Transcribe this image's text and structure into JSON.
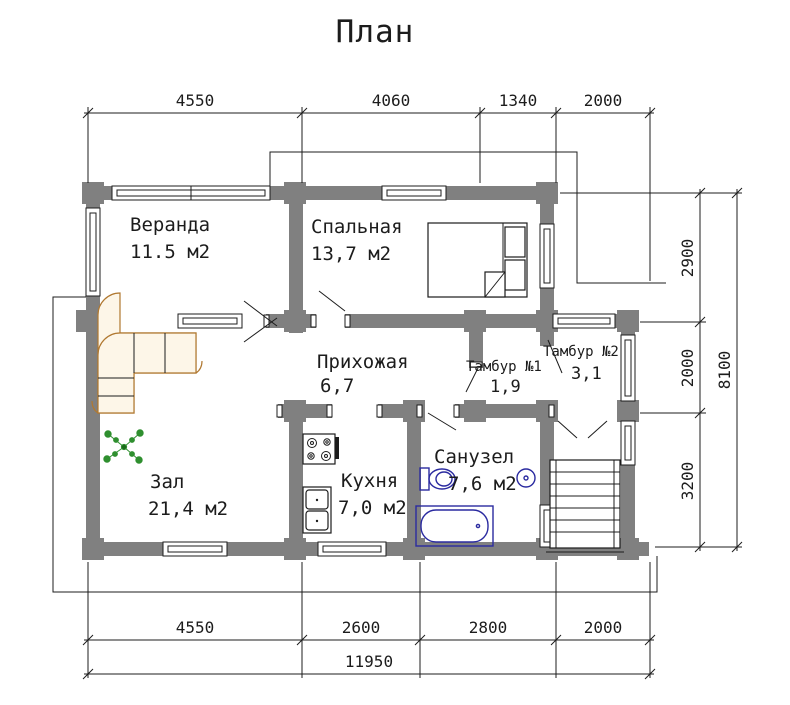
{
  "title": "План",
  "rooms": [
    {
      "id": "veranda",
      "label": "Веранда",
      "area": "11.5 м2"
    },
    {
      "id": "bedroom",
      "label": "Спальная",
      "area": "13,7 м2"
    },
    {
      "id": "hallway",
      "label": "Прихожая",
      "area": "6,7"
    },
    {
      "id": "tambour-1",
      "label": "Тамбур №1",
      "area": "1,9"
    },
    {
      "id": "tambour-2",
      "label": "Тамбур №2",
      "area": "3,1"
    },
    {
      "id": "hall",
      "label": "Зал",
      "area": "21,4 м2"
    },
    {
      "id": "kitchen",
      "label": "Кухня",
      "area": "7,0 м2"
    },
    {
      "id": "bathroom",
      "label": "Санузел",
      "area": "7,6 м2"
    }
  ],
  "dimensions": {
    "top": [
      "4550",
      "4060",
      "1340",
      "2000"
    ],
    "bottom": [
      "4550",
      "2600",
      "2800",
      "2000"
    ],
    "bottom_total": "11950",
    "right": [
      "2900",
      "2000",
      "3200"
    ],
    "right_total": "8100"
  },
  "colors": {
    "wall": "#808080",
    "sofa_outline": "#b07830",
    "plant_green": "#2f8f2f",
    "sanitary_blue": "#2a2aa0",
    "line": "#1c1c1c"
  }
}
